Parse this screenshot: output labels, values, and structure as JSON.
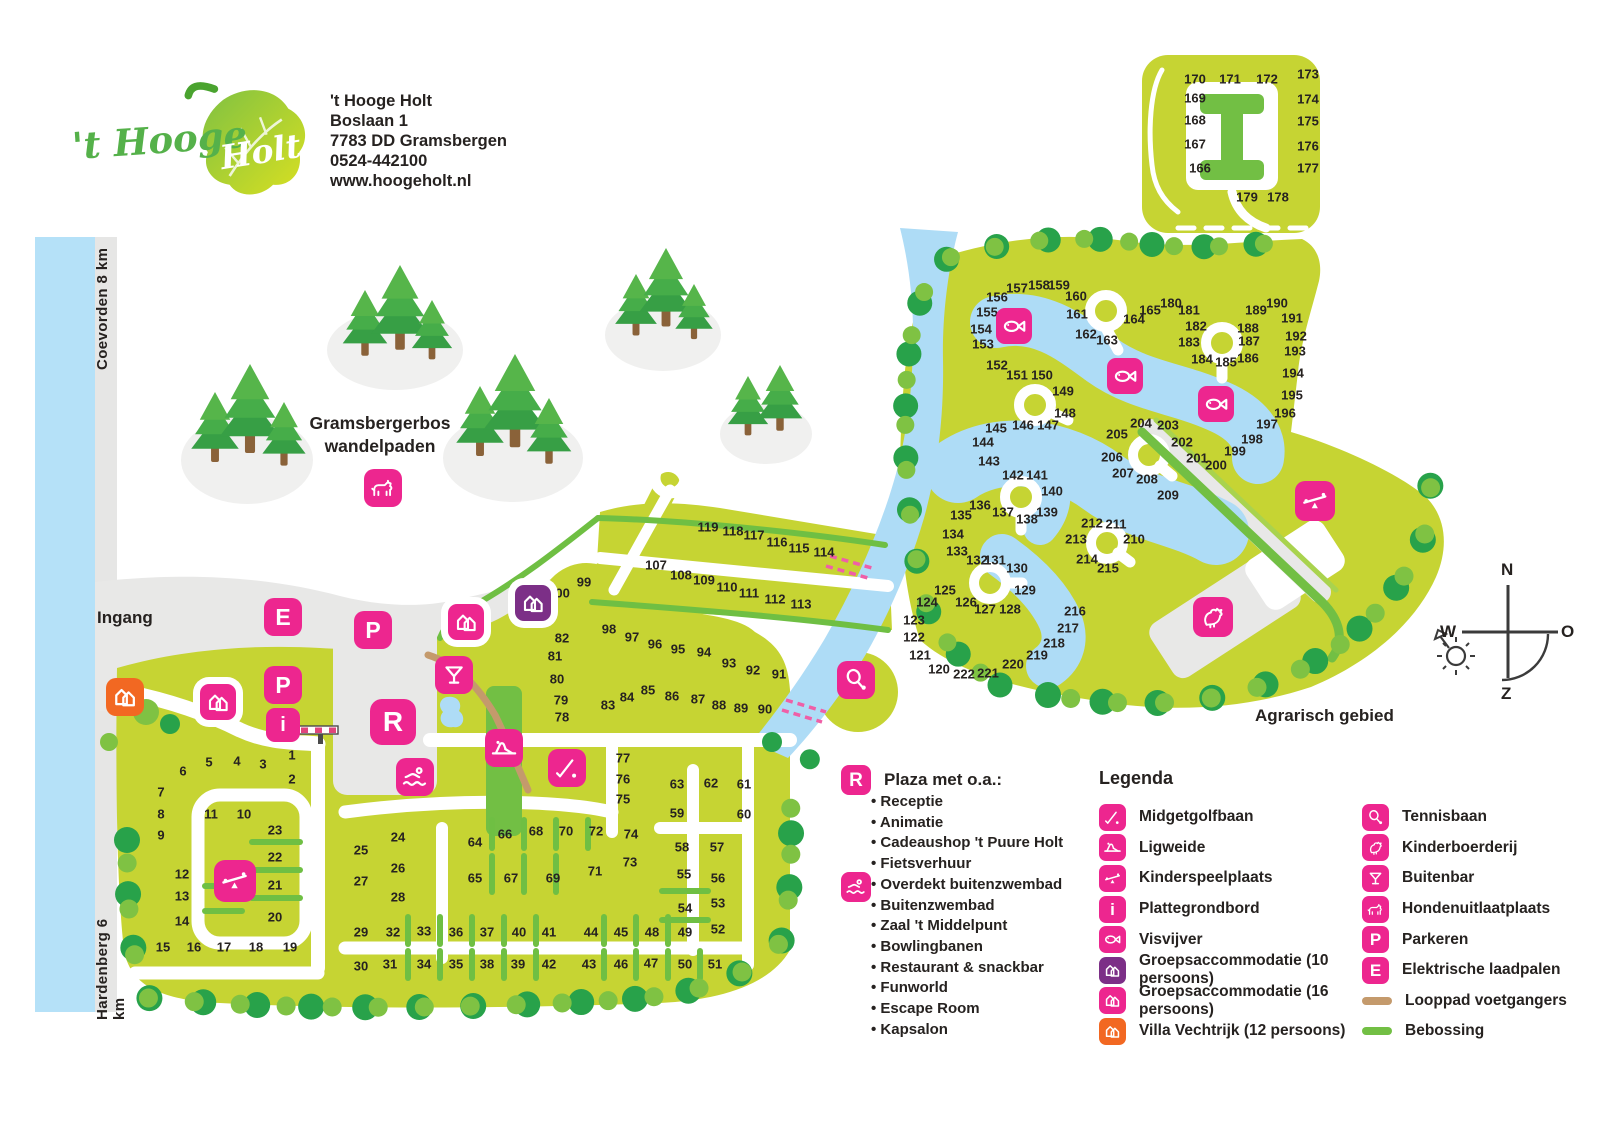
{
  "colors": {
    "pink": "#ed268f",
    "purple": "#7c2f87",
    "orange": "#f26822",
    "tan": "#c49a6c",
    "green": "#72bf44"
  },
  "site": {
    "script1": "'t Hooge",
    "script2": "Holt",
    "address": [
      "'t Hooge Holt",
      "Boslaan 1",
      "7783 DD Gramsbergen",
      "0524-442100",
      "www.hoogeholt.nl"
    ]
  },
  "roads": {
    "top": "Coevorden 8 km",
    "bottom": "Hardenberg 6 km"
  },
  "labels": {
    "entrance": "Ingang",
    "forest1": "Gramsbergerbos",
    "forest2": "wandelpaden",
    "agrarian": "Agrarisch gebied"
  },
  "compass": {
    "n": "N",
    "e": "O",
    "s": "Z",
    "w": "W"
  },
  "plaza": {
    "title": "Plaza met o.a.:",
    "items": [
      "Receptie",
      "Animatie",
      "Cadeaushop 't Puure Holt",
      "Fietsverhuur",
      "Overdekt buitenzwembad",
      "Buitenzwembad",
      "Zaal 't Middelpunt",
      "Bowlingbanen",
      "Restaurant & snackbar",
      "Funworld",
      "Escape Room",
      "Kapsalon"
    ]
  },
  "legend": {
    "title": "Legenda",
    "col1": [
      [
        "midgetgolf",
        "Midgetgolfbaan"
      ],
      [
        "ligweide",
        "Ligweide"
      ],
      [
        "kinderspeelplaats",
        "Kinderspeelplaats"
      ],
      [
        "plattegrondbord",
        "Plattegrondbord"
      ],
      [
        "visvijver",
        "Visvijver"
      ],
      [
        "groeps10",
        "Groepsaccommodatie (10 persoons)"
      ],
      [
        "groeps16",
        "Groepsaccommodatie (16 persoons)"
      ],
      [
        "villa12",
        "Villa Vechtrijk (12 persoons)"
      ]
    ],
    "col2": [
      [
        "tennis",
        "Tennisbaan"
      ],
      [
        "kinderboerderij",
        "Kinderboerderij"
      ],
      [
        "buitenbar",
        "Buitenbar"
      ],
      [
        "hond",
        "Hondenuitlaatplaats"
      ],
      [
        "parkeren",
        "Parkeren"
      ],
      [
        "elektrisch",
        "Elektrische laadpalen"
      ],
      [
        "looppad",
        "Looppad voetgangers"
      ],
      [
        "bebossing",
        "Bebossing"
      ]
    ]
  },
  "map_icons": [
    [
      "plattegrondbord",
      283,
      725,
      34,
      0
    ],
    [
      "elektrisch",
      283,
      617,
      38,
      0
    ],
    [
      "parkeren",
      373,
      630,
      38,
      0
    ],
    [
      "parkeren",
      283,
      685,
      38,
      0
    ],
    [
      "plaza",
      393,
      722,
      46,
      0
    ],
    [
      "zwembad",
      415,
      777,
      38,
      0
    ],
    [
      "buitenbar",
      454,
      675,
      38,
      0
    ],
    [
      "ligweide",
      504,
      748,
      38,
      0
    ],
    [
      "midgetgolf",
      567,
      768,
      38,
      0
    ],
    [
      "kinderspeelplaats",
      235,
      881,
      42,
      0
    ],
    [
      "kinderspeelplaats",
      1315,
      501,
      40,
      0
    ],
    [
      "groeps16",
      218,
      702,
      36,
      1
    ],
    [
      "groeps16",
      466,
      622,
      36,
      1
    ],
    [
      "groeps10",
      533,
      603,
      36,
      1
    ],
    [
      "villa12",
      125,
      697,
      38,
      0
    ],
    [
      "hond",
      383,
      488,
      38,
      0
    ],
    [
      "visvijver",
      1014,
      326,
      36,
      0
    ],
    [
      "visvijver",
      1125,
      376,
      36,
      0
    ],
    [
      "visvijver",
      1216,
      404,
      36,
      0
    ],
    [
      "tennis",
      856,
      680,
      38,
      0
    ],
    [
      "kinderboerderij",
      1213,
      617,
      40,
      0
    ]
  ],
  "plots": [
    [
      1,
      292,
      755
    ],
    [
      2,
      292,
      779
    ],
    [
      3,
      263,
      764
    ],
    [
      4,
      237,
      761
    ],
    [
      5,
      209,
      762
    ],
    [
      6,
      183,
      771
    ],
    [
      7,
      161,
      792
    ],
    [
      8,
      161,
      814
    ],
    [
      9,
      161,
      835
    ],
    [
      10,
      244,
      814
    ],
    [
      11,
      211,
      814
    ],
    [
      12,
      182,
      874
    ],
    [
      13,
      182,
      896
    ],
    [
      14,
      182,
      921
    ],
    [
      15,
      163,
      947
    ],
    [
      16,
      194,
      947
    ],
    [
      17,
      224,
      947
    ],
    [
      18,
      256,
      947
    ],
    [
      19,
      290,
      947
    ],
    [
      20,
      275,
      917
    ],
    [
      21,
      275,
      885
    ],
    [
      22,
      275,
      857
    ],
    [
      23,
      275,
      830
    ],
    [
      24,
      398,
      837
    ],
    [
      25,
      361,
      850
    ],
    [
      26,
      398,
      868
    ],
    [
      27,
      361,
      881
    ],
    [
      28,
      398,
      897
    ],
    [
      29,
      361,
      932
    ],
    [
      30,
      361,
      966
    ],
    [
      31,
      390,
      964
    ],
    [
      32,
      393,
      932
    ],
    [
      33,
      424,
      931
    ],
    [
      34,
      424,
      964
    ],
    [
      35,
      456,
      964
    ],
    [
      36,
      456,
      932
    ],
    [
      37,
      487,
      932
    ],
    [
      38,
      487,
      964
    ],
    [
      39,
      518,
      964
    ],
    [
      40,
      519,
      932
    ],
    [
      41,
      549,
      932
    ],
    [
      42,
      549,
      964
    ],
    [
      43,
      589,
      964
    ],
    [
      44,
      591,
      932
    ],
    [
      45,
      621,
      932
    ],
    [
      46,
      621,
      964
    ],
    [
      47,
      651,
      963
    ],
    [
      48,
      652,
      932
    ],
    [
      49,
      685,
      932
    ],
    [
      50,
      685,
      964
    ],
    [
      51,
      715,
      964
    ],
    [
      52,
      718,
      929
    ],
    [
      53,
      718,
      903
    ],
    [
      54,
      685,
      908
    ],
    [
      55,
      684,
      874
    ],
    [
      56,
      718,
      878
    ],
    [
      57,
      717,
      847
    ],
    [
      58,
      682,
      847
    ],
    [
      59,
      677,
      813
    ],
    [
      60,
      744,
      814
    ],
    [
      61,
      744,
      784
    ],
    [
      62,
      711,
      783
    ],
    [
      63,
      677,
      784
    ],
    [
      64,
      475,
      842
    ],
    [
      65,
      475,
      878
    ],
    [
      66,
      505,
      834
    ],
    [
      67,
      511,
      878
    ],
    [
      68,
      536,
      831
    ],
    [
      69,
      553,
      878
    ],
    [
      70,
      566,
      831
    ],
    [
      71,
      595,
      871
    ],
    [
      72,
      596,
      831
    ],
    [
      73,
      630,
      862
    ],
    [
      74,
      631,
      834
    ],
    [
      75,
      623,
      799
    ],
    [
      76,
      623,
      779
    ],
    [
      77,
      623,
      758
    ],
    [
      78,
      562,
      717
    ],
    [
      79,
      561,
      700
    ],
    [
      80,
      557,
      679
    ],
    [
      81,
      555,
      656
    ],
    [
      82,
      562,
      638
    ],
    [
      83,
      608,
      705
    ],
    [
      84,
      627,
      697
    ],
    [
      85,
      648,
      690
    ],
    [
      86,
      672,
      696
    ],
    [
      87,
      698,
      699
    ],
    [
      88,
      719,
      705
    ],
    [
      89,
      741,
      708
    ],
    [
      90,
      765,
      709
    ],
    [
      91,
      779,
      674
    ],
    [
      92,
      753,
      670
    ],
    [
      93,
      729,
      663
    ],
    [
      94,
      704,
      652
    ],
    [
      95,
      678,
      649
    ],
    [
      96,
      655,
      644
    ],
    [
      97,
      632,
      637
    ],
    [
      98,
      609,
      629
    ],
    [
      99,
      584,
      582
    ],
    [
      100,
      559,
      593
    ],
    [
      107,
      656,
      565
    ],
    [
      108,
      681,
      575
    ],
    [
      109,
      704,
      580
    ],
    [
      110,
      727,
      587
    ],
    [
      111,
      749,
      593
    ],
    [
      112,
      775,
      599
    ],
    [
      113,
      801,
      604
    ],
    [
      114,
      824,
      552
    ],
    [
      115,
      799,
      548
    ],
    [
      116,
      777,
      542
    ],
    [
      117,
      754,
      535
    ],
    [
      118,
      733,
      531
    ],
    [
      119,
      708,
      527
    ],
    [
      120,
      939,
      669
    ],
    [
      121,
      920,
      655
    ],
    [
      122,
      914,
      637
    ],
    [
      123,
      914,
      620
    ],
    [
      124,
      927,
      602
    ],
    [
      125,
      945,
      590
    ],
    [
      126,
      966,
      602
    ],
    [
      127,
      985,
      609
    ],
    [
      128,
      1010,
      609
    ],
    [
      129,
      1025,
      590
    ],
    [
      130,
      1017,
      568
    ],
    [
      131,
      995,
      560
    ],
    [
      132,
      977,
      560
    ],
    [
      133,
      957,
      551
    ],
    [
      134,
      953,
      534
    ],
    [
      135,
      961,
      515
    ],
    [
      136,
      980,
      505
    ],
    [
      137,
      1003,
      512
    ],
    [
      138,
      1027,
      519
    ],
    [
      139,
      1047,
      512
    ],
    [
      140,
      1052,
      491
    ],
    [
      141,
      1037,
      475
    ],
    [
      142,
      1013,
      475
    ],
    [
      143,
      989,
      461
    ],
    [
      144,
      983,
      442
    ],
    [
      145,
      996,
      428
    ],
    [
      146,
      1023,
      425
    ],
    [
      147,
      1048,
      425
    ],
    [
      148,
      1065,
      413
    ],
    [
      149,
      1063,
      391
    ],
    [
      150,
      1042,
      375
    ],
    [
      151,
      1017,
      375
    ],
    [
      152,
      997,
      365
    ],
    [
      153,
      983,
      344
    ],
    [
      154,
      981,
      329
    ],
    [
      155,
      987,
      312
    ],
    [
      156,
      997,
      297
    ],
    [
      157,
      1017,
      288
    ],
    [
      158,
      1039,
      285
    ],
    [
      159,
      1059,
      285
    ],
    [
      160,
      1076,
      296
    ],
    [
      161,
      1077,
      314
    ],
    [
      162,
      1086,
      334
    ],
    [
      163,
      1107,
      340
    ],
    [
      164,
      1134,
      319
    ],
    [
      165,
      1150,
      310
    ],
    [
      166,
      1200,
      168
    ],
    [
      167,
      1195,
      144
    ],
    [
      168,
      1195,
      120
    ],
    [
      169,
      1195,
      98
    ],
    [
      170,
      1195,
      79
    ],
    [
      171,
      1230,
      79
    ],
    [
      172,
      1267,
      79
    ],
    [
      173,
      1308,
      74
    ],
    [
      174,
      1308,
      99
    ],
    [
      175,
      1308,
      121
    ],
    [
      176,
      1308,
      146
    ],
    [
      177,
      1308,
      168
    ],
    [
      178,
      1278,
      197
    ],
    [
      179,
      1247,
      197
    ],
    [
      180,
      1171,
      303
    ],
    [
      181,
      1189,
      310
    ],
    [
      182,
      1196,
      326
    ],
    [
      183,
      1189,
      342
    ],
    [
      184,
      1202,
      359
    ],
    [
      185,
      1226,
      362
    ],
    [
      186,
      1248,
      358
    ],
    [
      187,
      1249,
      341
    ],
    [
      188,
      1248,
      328
    ],
    [
      189,
      1256,
      310
    ],
    [
      190,
      1277,
      303
    ],
    [
      191,
      1292,
      318
    ],
    [
      192,
      1296,
      336
    ],
    [
      193,
      1295,
      351
    ],
    [
      194,
      1293,
      373
    ],
    [
      195,
      1292,
      395
    ],
    [
      196,
      1285,
      413
    ],
    [
      197,
      1267,
      424
    ],
    [
      198,
      1252,
      439
    ],
    [
      199,
      1235,
      451
    ],
    [
      200,
      1216,
      465
    ],
    [
      201,
      1197,
      458
    ],
    [
      202,
      1182,
      442
    ],
    [
      203,
      1168,
      425
    ],
    [
      204,
      1141,
      423
    ],
    [
      205,
      1117,
      434
    ],
    [
      206,
      1112,
      457
    ],
    [
      207,
      1123,
      473
    ],
    [
      208,
      1147,
      479
    ],
    [
      209,
      1168,
      495
    ],
    [
      210,
      1134,
      539
    ],
    [
      211,
      1116,
      524
    ],
    [
      212,
      1092,
      523
    ],
    [
      213,
      1076,
      539
    ],
    [
      214,
      1087,
      559
    ],
    [
      215,
      1108,
      568
    ],
    [
      216,
      1075,
      611
    ],
    [
      217,
      1068,
      628
    ],
    [
      218,
      1054,
      643
    ],
    [
      219,
      1037,
      655
    ],
    [
      220,
      1013,
      664
    ],
    [
      221,
      988,
      673
    ],
    [
      222,
      964,
      674
    ]
  ]
}
